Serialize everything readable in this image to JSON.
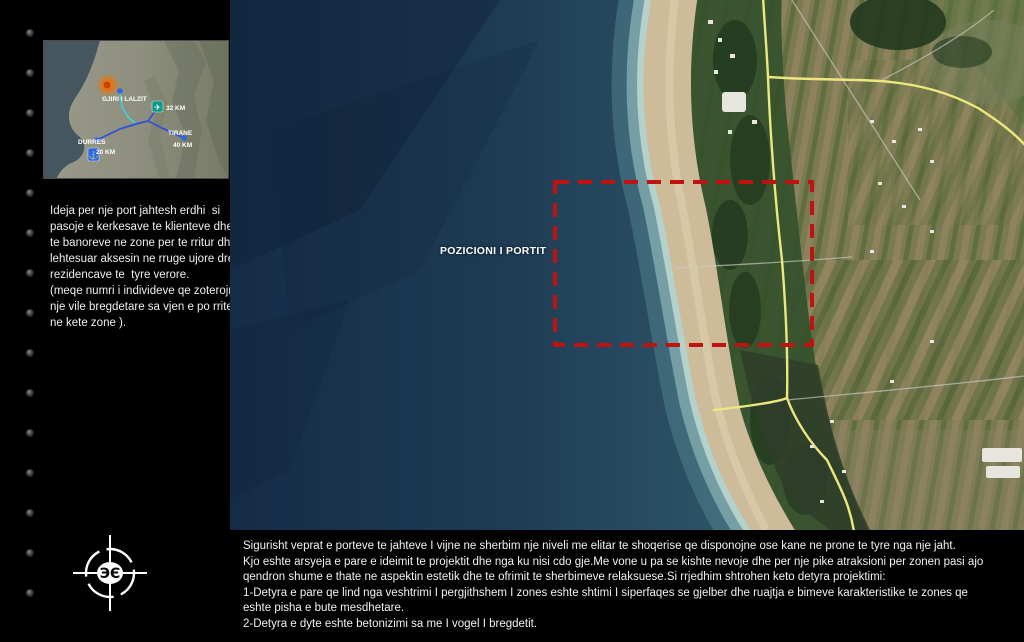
{
  "slide": {
    "background": "#000000"
  },
  "inset_map": {
    "site_label": "GJIRI I LALZIT",
    "airport_distance": "32 KM",
    "tirane_label": "TIRANE",
    "tirane_distance": "40 KM",
    "durres_label": "DURRES",
    "durres_distance": "20 KM",
    "route_color": "#3050d8",
    "site_marker_color": "#e07818"
  },
  "sidebar": {
    "paragraph": "Ideja per nje port jahtesh erdhi  si\npasoje e kerkesave te klienteve dhe\nte banoreve ne zone per te rritur dhe\nlehtesuar aksesin ne rruge ujore drejt\nrezidencave te  tyre verore.\n(meqe numri i individeve qe zoterojne\nnje vile bregdetare sa vjen e po rritet\nne kete zone )."
  },
  "map": {
    "port_label": "POZICIONI I PORTIT",
    "port_area_outline_color": "#bf1311",
    "road_color": "#ece780"
  },
  "footer": {
    "paragraph": "Sigurisht veprat e porteve te jahteve I vijne ne sherbim nje niveli me elitar te shoqerise qe disponojne ose kane ne prone te tyre nga nje jaht.\nKjo eshte arsyeja e pare e ideimit te projektit dhe nga ku nisi cdo gje.Me vone u pa se kishte nevoje dhe per nje pike atraksioni per zonen pasi ajo\nqendron shume e thate ne aspektin estetik dhe te ofrimit te sherbimeve relaksuese.Si rrjedhim shtrohen keto detyra projektimi:\n1-Detyra e pare qe lind nga veshtrimi I pergjithshem I zones eshte shtimi I siperfaqes se gjelber dhe ruajtja e bimeve karakteristike te zones qe\neshte pisha e bute mesdhetare.\n2-Detyra e dyte eshte betonizimi sa me I vogel I bregdetit."
  }
}
